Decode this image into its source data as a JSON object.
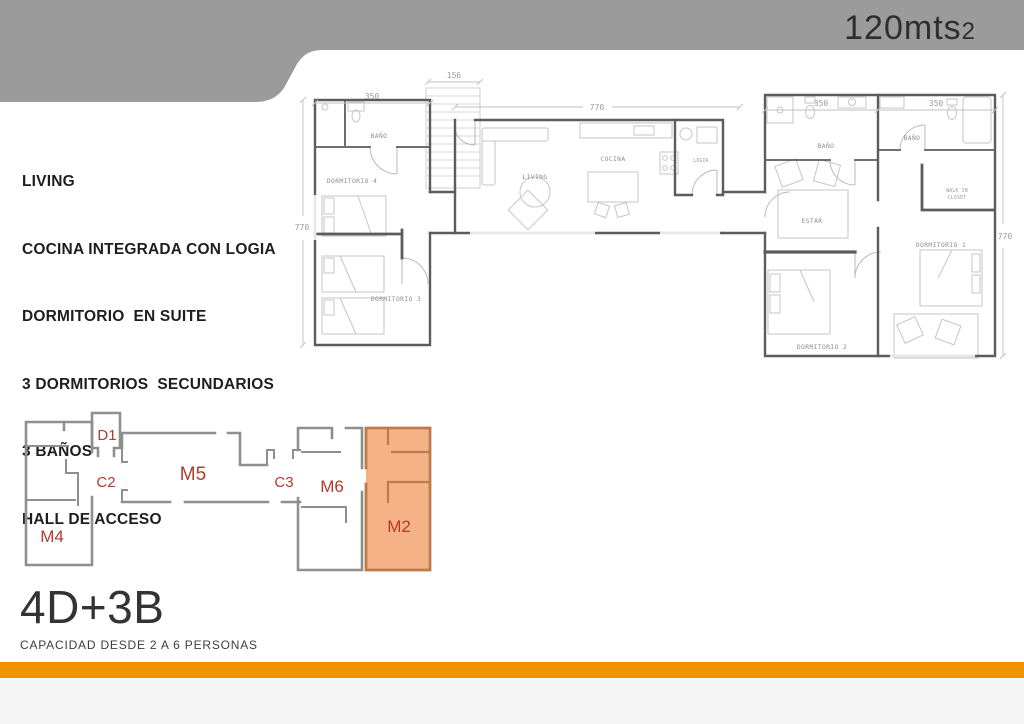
{
  "header": {
    "area_value": "120mts",
    "area_exponent": "2",
    "banner_color": "#9b9b9b",
    "text_color": "#2e2e31"
  },
  "features": {
    "lines": [
      "LIVING",
      "COCINA INTEGRADA CON LOGIA",
      "DORMITORIO  EN SUITE",
      "3 DORMITORIOS  SECUNDARIOS",
      "3 BAÑOS",
      "HALL DE ACCESO"
    ]
  },
  "floor_plan": {
    "room_labels": {
      "bano_d4": "BAÑO",
      "dormitorio4": "DORMITORIO 4",
      "dormitorio3": "DORMITORIO 3",
      "living": "LIVING",
      "cocina": "COCINA",
      "logia": "LOGIA",
      "bano_estar": "BAÑO",
      "bano_d1": "BAÑO",
      "estar": "ESTAR",
      "walkin_line1": "WALK IN",
      "walkin_line2": "CLOSET",
      "dormitorio1": "DORMITORIO 1",
      "dormitorio2": "DORMITORIO 2"
    },
    "dimensions": {
      "left_width": "350",
      "entry_width": "156",
      "center_width": "770",
      "right_width_a": "350",
      "right_width_b": "350",
      "left_height": "770",
      "right_height": "770"
    },
    "wall_color": "#5c5c5c"
  },
  "key_plan": {
    "highlight_color": "#f5b286",
    "wall_color": "#8f8f8f",
    "label_color": "#b23b2e",
    "modules": [
      {
        "id": "M4",
        "label": "M4",
        "highlighted": false
      },
      {
        "id": "D1",
        "label": "D1",
        "highlighted": false
      },
      {
        "id": "C2",
        "label": "C2",
        "highlighted": false
      },
      {
        "id": "M5",
        "label": "M5",
        "highlighted": false
      },
      {
        "id": "C3",
        "label": "C3",
        "highlighted": false
      },
      {
        "id": "M6",
        "label": "M6",
        "highlighted": false
      },
      {
        "id": "M2",
        "label": "M2",
        "highlighted": true
      }
    ]
  },
  "summary": {
    "title": "4D+3B",
    "subtitle": "CAPACIDAD DESDE 2 A 6 PERSONAS"
  },
  "footer": {
    "bar_color": "#f29200",
    "strip_color": "#f5f5f5"
  }
}
